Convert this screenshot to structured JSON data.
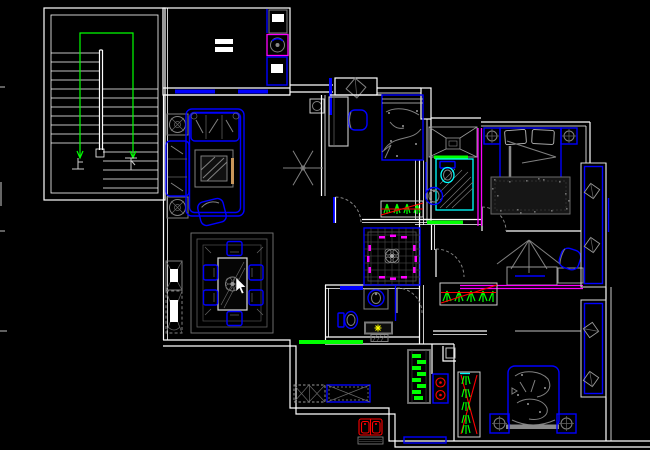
{
  "canvas": {
    "width": 650,
    "height": 450,
    "background": "#000000"
  },
  "colors": {
    "background": "#000000",
    "wall": "#ffffff",
    "blue": "#0000ff",
    "gray": "#808080",
    "lightgray": "#cccccc",
    "green": "#00ff00",
    "cyan": "#00ffff",
    "magenta": "#ff00ff",
    "red": "#ff0000",
    "yellow": "#ffff00",
    "tan": "#c8965a"
  },
  "stairwell": {
    "up_label": "上",
    "down_label": "下",
    "handrail_color": "#00ff00",
    "treads_left": 11,
    "treads_right": 12
  },
  "rooms": {
    "stairwell": {
      "name": "stairwell",
      "features": [
        "stairs",
        "center-divider",
        "handrail"
      ]
    },
    "laundry": {
      "name": "laundry-storage",
      "features": [
        "cabinet",
        "washing-machine",
        "cabinet",
        "counter-marks"
      ]
    },
    "living_room": {
      "name": "living-room",
      "features": [
        "corner-plant",
        "three-seat-sofa",
        "side-sofa",
        "armchair",
        "coffee-table",
        "rug-border",
        "pendant-lamp"
      ]
    },
    "dining_room": {
      "name": "dining-room",
      "features": [
        "area-rug",
        "dining-table",
        "six-chairs",
        "console-cabinet",
        "console-cabinet-2"
      ]
    },
    "bedroom_middle": {
      "name": "bedroom-2",
      "features": [
        "window-leaf",
        "desk",
        "chair",
        "single-bed",
        "planter",
        "door-swing"
      ]
    },
    "foyer": {
      "name": "foyer",
      "features": [
        "decorative-floor-tile",
        "magenta-inlay",
        "center-medallion"
      ]
    },
    "bathroom_main": {
      "name": "bathroom",
      "features": [
        "toilet",
        "washbasin",
        "vanity-light",
        "floor-mat",
        "door-swing",
        "threshold"
      ]
    },
    "kitchen": {
      "name": "kitchen",
      "features": [
        "base-cabinets",
        "tall-cabinet",
        "gas-stove",
        "double-sink",
        "drainboard",
        "window-ledge"
      ]
    },
    "ensuite_bath": {
      "name": "ensuite-bathroom",
      "features": [
        "vanity-counter",
        "shower-tile",
        "toilet",
        "washbasin",
        "thresholds"
      ]
    },
    "master_bedroom": {
      "name": "master-bedroom",
      "features": [
        "double-bed",
        "pillows",
        "nightstand-left",
        "nightstand-right",
        "ceiling-lamps",
        "area-rug",
        "door-swing"
      ]
    },
    "study": {
      "name": "study",
      "features": [
        "wall-lamp",
        "desk",
        "keyboard",
        "side-table",
        "office-chair",
        "planter"
      ]
    },
    "bedroom_bottom": {
      "name": "bedroom-3",
      "features": [
        "single-bed",
        "headboard",
        "nightstand-left",
        "nightstand-right",
        "ceiling-lamps",
        "planter-strip"
      ]
    },
    "bay_windows": {
      "name": "bay-windows",
      "features": [
        "bay-1",
        "bay-2",
        "diamond-decor"
      ]
    }
  },
  "cursor": {
    "x": 236,
    "y": 279,
    "shape": "arrow",
    "color": "#ffffff"
  }
}
